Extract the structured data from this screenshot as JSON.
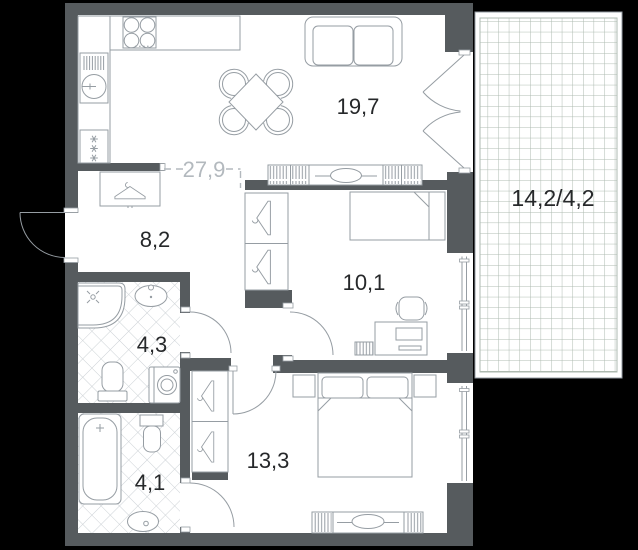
{
  "plan": {
    "title": "Two-bedroom apartment floor plan",
    "labels": {
      "living": "19,7",
      "kitchen_living_total": "27,9",
      "hall": "8,2",
      "bedroom_small": "10,1",
      "bathroom_main": "4,3",
      "bedroom_master": "13,3",
      "bathroom_ensuite": "4,1",
      "balcony": "14,2/4,2"
    },
    "colors": {
      "background": "#000000",
      "wall": "#565b5e",
      "floor": "#ffffff",
      "furniture_line": "#969da3",
      "tile_line": "#ccd1d5",
      "balcony_grid": "#adbab0",
      "label": "#26282a",
      "muted_label": "#b3b9be"
    }
  }
}
